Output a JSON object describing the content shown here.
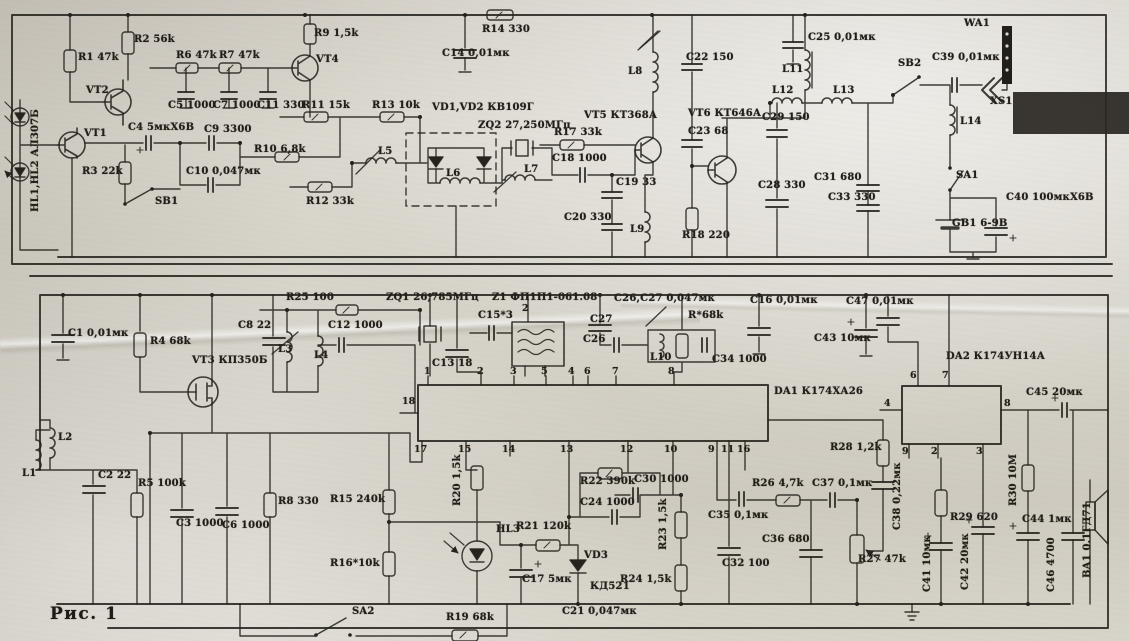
{
  "meta": {
    "ink": "#26231e",
    "paper": "#d7d3c9",
    "figure_kind": "scanned radio transceiver schematic"
  },
  "caption": {
    "text": "Рис. 1"
  },
  "labels": [
    {
      "t": "HL1,HL2 АЛ307Б",
      "x": 30,
      "y": 212,
      "v": 1
    },
    {
      "t": "R1 47k",
      "x": 78,
      "y": 52
    },
    {
      "t": "R2 56k",
      "x": 134,
      "y": 34
    },
    {
      "t": "VT2",
      "x": 86,
      "y": 85
    },
    {
      "t": "VT1",
      "x": 84,
      "y": 128
    },
    {
      "t": "R3 22k",
      "x": 82,
      "y": 166
    },
    {
      "t": "C4 5мкХ6В",
      "x": 128,
      "y": 122
    },
    {
      "t": "C9 3300",
      "x": 204,
      "y": 124
    },
    {
      "t": "C10 0,047мк",
      "x": 186,
      "y": 166
    },
    {
      "t": "SB1",
      "x": 155,
      "y": 196
    },
    {
      "t": "R6 47k",
      "x": 176,
      "y": 50
    },
    {
      "t": "R7 47k",
      "x": 219,
      "y": 50
    },
    {
      "t": "C5 1000",
      "x": 168,
      "y": 100
    },
    {
      "t": "C7 1000",
      "x": 213,
      "y": 100
    },
    {
      "t": "C11 330",
      "x": 257,
      "y": 100
    },
    {
      "t": "R9 1,5k",
      "x": 314,
      "y": 28
    },
    {
      "t": "VT4",
      "x": 316,
      "y": 54
    },
    {
      "t": "R10 6,8k",
      "x": 254,
      "y": 144
    },
    {
      "t": "R11 15k",
      "x": 302,
      "y": 100
    },
    {
      "t": "R12 33k",
      "x": 306,
      "y": 196
    },
    {
      "t": "R13 10k",
      "x": 372,
      "y": 100
    },
    {
      "t": "R14 330",
      "x": 482,
      "y": 24
    },
    {
      "t": "C14 0,01мк",
      "x": 442,
      "y": 48
    },
    {
      "t": "VD1,VD2 КВ109Г",
      "x": 432,
      "y": 102
    },
    {
      "t": "ZQ2 27,250МГц",
      "x": 478,
      "y": 120
    },
    {
      "t": "L5",
      "x": 378,
      "y": 146
    },
    {
      "t": "L6",
      "x": 446,
      "y": 168
    },
    {
      "t": "L7",
      "x": 524,
      "y": 164
    },
    {
      "t": "R17 33k",
      "x": 554,
      "y": 127
    },
    {
      "t": "C18 1000",
      "x": 552,
      "y": 153
    },
    {
      "t": "C19 33",
      "x": 616,
      "y": 177
    },
    {
      "t": "C20 330",
      "x": 564,
      "y": 212
    },
    {
      "t": "L9",
      "x": 630,
      "y": 224
    },
    {
      "t": "VT5 КТ368А",
      "x": 584,
      "y": 110
    },
    {
      "t": "L8",
      "x": 628,
      "y": 66
    },
    {
      "t": "C22 150",
      "x": 686,
      "y": 52
    },
    {
      "t": "VT6 КТ646А",
      "x": 688,
      "y": 108
    },
    {
      "t": "C23 68",
      "x": 688,
      "y": 126
    },
    {
      "t": "R18 220",
      "x": 682,
      "y": 230
    },
    {
      "t": "C28 330",
      "x": 758,
      "y": 180
    },
    {
      "t": "L11",
      "x": 782,
      "y": 64
    },
    {
      "t": "C25 0,01мк",
      "x": 808,
      "y": 32
    },
    {
      "t": "L12",
      "x": 772,
      "y": 85
    },
    {
      "t": "L13",
      "x": 833,
      "y": 85
    },
    {
      "t": "C29 150",
      "x": 762,
      "y": 112
    },
    {
      "t": "C31 680",
      "x": 814,
      "y": 172
    },
    {
      "t": "C33 330",
      "x": 828,
      "y": 192
    },
    {
      "t": "WA1",
      "x": 964,
      "y": 18
    },
    {
      "t": "SB2",
      "x": 898,
      "y": 58
    },
    {
      "t": "C39 0,01мк",
      "x": 932,
      "y": 52
    },
    {
      "t": "XS1",
      "x": 990,
      "y": 96
    },
    {
      "t": "L14",
      "x": 960,
      "y": 116
    },
    {
      "t": "SA1",
      "x": 956,
      "y": 170
    },
    {
      "t": "GB1 6-9В",
      "x": 952,
      "y": 218
    },
    {
      "t": "C40 100мкХ6В",
      "x": 1006,
      "y": 192
    },
    {
      "t": "C1 0,01мк",
      "x": 68,
      "y": 328
    },
    {
      "t": "R4 68k",
      "x": 150,
      "y": 336
    },
    {
      "t": "VT3 КП350Б",
      "x": 192,
      "y": 355
    },
    {
      "t": "C8 22",
      "x": 238,
      "y": 320
    },
    {
      "t": "R25 100",
      "x": 286,
      "y": 292
    },
    {
      "t": "C12 1000",
      "x": 328,
      "y": 320
    },
    {
      "t": "L3",
      "x": 278,
      "y": 344
    },
    {
      "t": "L4",
      "x": 314,
      "y": 350
    },
    {
      "t": "ZQ1 26,785МГц",
      "x": 386,
      "y": 292
    },
    {
      "t": "Z1 ФП1П1-061.08",
      "x": 492,
      "y": 292
    },
    {
      "t": "C15*3",
      "x": 478,
      "y": 310
    },
    {
      "t": "C13 18",
      "x": 432,
      "y": 358
    },
    {
      "t": "C26,C27 0,047мк",
      "x": 614,
      "y": 293
    },
    {
      "t": "C27",
      "x": 590,
      "y": 314
    },
    {
      "t": "C26",
      "x": 583,
      "y": 334
    },
    {
      "t": "L10",
      "x": 650,
      "y": 352
    },
    {
      "t": "R*68k",
      "x": 688,
      "y": 310
    },
    {
      "t": "C34 1000",
      "x": 712,
      "y": 354
    },
    {
      "t": "C16 0,01мк",
      "x": 750,
      "y": 295
    },
    {
      "t": "C43 10мк",
      "x": 814,
      "y": 333
    },
    {
      "t": "C47 0,01мк",
      "x": 846,
      "y": 296
    },
    {
      "t": "DA1 К174ХА26",
      "x": 774,
      "y": 386
    },
    {
      "t": "DA2 К174УН14А",
      "x": 946,
      "y": 351
    },
    {
      "t": "C45 20мк",
      "x": 1026,
      "y": 387
    },
    {
      "t": "L1",
      "x": 22,
      "y": 468
    },
    {
      "t": "L2",
      "x": 58,
      "y": 432
    },
    {
      "t": "C2 22",
      "x": 98,
      "y": 470
    },
    {
      "t": "R5 100k",
      "x": 138,
      "y": 478
    },
    {
      "t": "C3 1000",
      "x": 176,
      "y": 518
    },
    {
      "t": "C6 1000",
      "x": 222,
      "y": 520
    },
    {
      "t": "R8 330",
      "x": 278,
      "y": 496
    },
    {
      "t": "R15 240k",
      "x": 330,
      "y": 494
    },
    {
      "t": "R16*10k",
      "x": 330,
      "y": 558
    },
    {
      "t": "SA2",
      "x": 352,
      "y": 606
    },
    {
      "t": "R19 68k",
      "x": 446,
      "y": 612
    },
    {
      "t": "R20 1,5k",
      "x": 452,
      "y": 506,
      "v": 1
    },
    {
      "t": "HL3",
      "x": 496,
      "y": 524
    },
    {
      "t": "R21 120k",
      "x": 516,
      "y": 521
    },
    {
      "t": "C17 5мк",
      "x": 522,
      "y": 574
    },
    {
      "t": "VD3",
      "x": 584,
      "y": 550
    },
    {
      "t": "КД521",
      "x": 590,
      "y": 581
    },
    {
      "t": "R22 390k",
      "x": 580,
      "y": 476
    },
    {
      "t": "C24 1000",
      "x": 580,
      "y": 497
    },
    {
      "t": "C30 1000",
      "x": 634,
      "y": 474
    },
    {
      "t": "R23 1,5k",
      "x": 658,
      "y": 550,
      "v": 1
    },
    {
      "t": "R24 1,5k",
      "x": 620,
      "y": 574
    },
    {
      "t": "C21 0,047мк",
      "x": 562,
      "y": 606
    },
    {
      "t": "C32 100",
      "x": 722,
      "y": 558
    },
    {
      "t": "C35 0,1мк",
      "x": 708,
      "y": 510
    },
    {
      "t": "R26 4,7k",
      "x": 752,
      "y": 478
    },
    {
      "t": "C36 680",
      "x": 762,
      "y": 534
    },
    {
      "t": "C37 0,1мк",
      "x": 812,
      "y": 478
    },
    {
      "t": "R27 47k",
      "x": 858,
      "y": 554
    },
    {
      "t": "R28 1,2k",
      "x": 830,
      "y": 442
    },
    {
      "t": "C38 0,22мк",
      "x": 892,
      "y": 530,
      "v": 1
    },
    {
      "t": "C41 10мк",
      "x": 922,
      "y": 592,
      "v": 1
    },
    {
      "t": "R29 620",
      "x": 950,
      "y": 512
    },
    {
      "t": "C42 20мк",
      "x": 960,
      "y": 590,
      "v": 1
    },
    {
      "t": "R30 10М",
      "x": 1008,
      "y": 506,
      "v": 1
    },
    {
      "t": "C44 1мк",
      "x": 1022,
      "y": 514
    },
    {
      "t": "C46 4700",
      "x": 1046,
      "y": 592,
      "v": 1
    },
    {
      "t": "BA1 0.1ГД71",
      "x": 1082,
      "y": 578,
      "v": 1
    }
  ],
  "pins": [
    {
      "t": "18",
      "x": 402,
      "y": 396
    },
    {
      "t": "1",
      "x": 424,
      "y": 366
    },
    {
      "t": "2",
      "x": 477,
      "y": 366
    },
    {
      "t": "3",
      "x": 510,
      "y": 366
    },
    {
      "t": "5",
      "x": 541,
      "y": 366
    },
    {
      "t": "4",
      "x": 568,
      "y": 366
    },
    {
      "t": "6",
      "x": 584,
      "y": 366
    },
    {
      "t": "7",
      "x": 612,
      "y": 366
    },
    {
      "t": "8",
      "x": 668,
      "y": 366
    },
    {
      "t": "17",
      "x": 414,
      "y": 444
    },
    {
      "t": "15",
      "x": 458,
      "y": 444
    },
    {
      "t": "14",
      "x": 502,
      "y": 444
    },
    {
      "t": "13",
      "x": 560,
      "y": 444
    },
    {
      "t": "12",
      "x": 620,
      "y": 444
    },
    {
      "t": "10",
      "x": 664,
      "y": 444
    },
    {
      "t": "9",
      "x": 708,
      "y": 444
    },
    {
      "t": "11",
      "x": 721,
      "y": 444
    },
    {
      "t": "16",
      "x": 737,
      "y": 444
    },
    {
      "t": "2",
      "x": 522,
      "y": 303
    },
    {
      "t": "6",
      "x": 910,
      "y": 370
    },
    {
      "t": "7",
      "x": 942,
      "y": 370
    },
    {
      "t": "4",
      "x": 884,
      "y": 398
    },
    {
      "t": "8",
      "x": 1004,
      "y": 398
    },
    {
      "t": "9",
      "x": 902,
      "y": 446
    },
    {
      "t": "2",
      "x": 931,
      "y": 446
    },
    {
      "t": "3",
      "x": 976,
      "y": 446
    }
  ]
}
